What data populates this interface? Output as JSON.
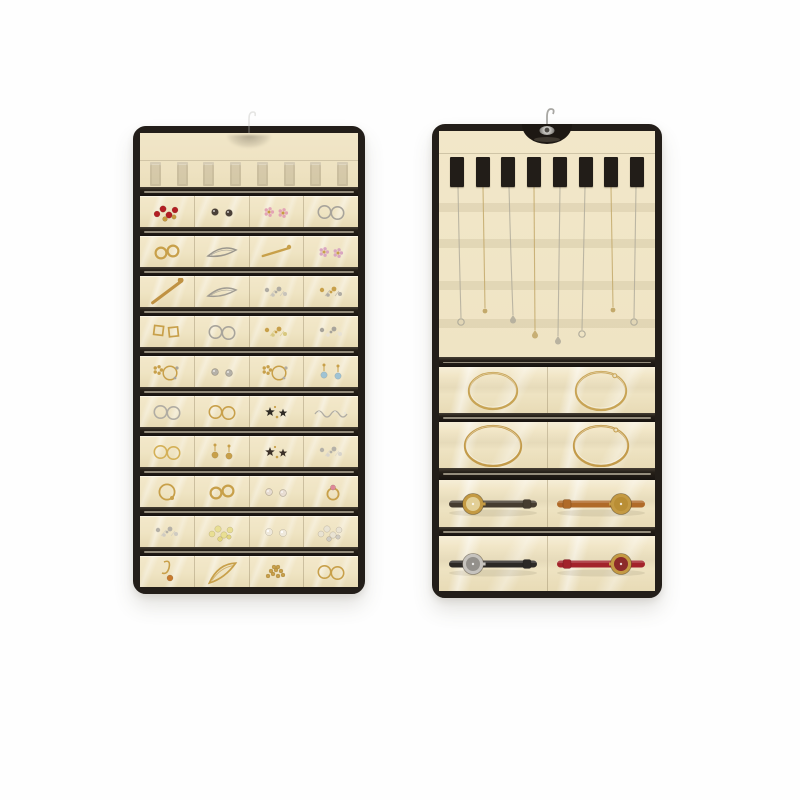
{
  "product": {
    "name": "dual-sided-hanging-jewelry-organizer",
    "sides": [
      "front-small-pocket-panel",
      "back-necklace-and-watch-panel"
    ]
  },
  "palette": {
    "background": "#fefefe",
    "fabric": "#efe4c5",
    "trim": "#231e19",
    "gold": "#c69f4a",
    "silver": "#aaa69c",
    "metal_hook": "#a8a7a3"
  },
  "front_panel": {
    "ghost_straps": 8,
    "rows": [
      [
        {
          "t": "beadcluster",
          "c": [
            "#b31e24",
            "#c79a3f"
          ],
          "n": "red-bead-gold-earrings"
        },
        {
          "t": "studs",
          "c": [
            "#4a4038",
            "#6a5f52"
          ],
          "n": "black-stud-earrings"
        },
        {
          "t": "flower",
          "c": [
            "#e3a4b5",
            "#c79a3f"
          ],
          "n": "pink-flower-stud"
        },
        {
          "t": "hoops2",
          "c": [
            "#a8a49b"
          ],
          "n": "silver-interlocked-hoops"
        }
      ],
      [
        {
          "t": "rings2",
          "c": [
            "#c8a04a"
          ],
          "n": "gold-ring-pair"
        },
        {
          "t": "marquise",
          "c": [
            "#9a968d"
          ],
          "n": "silver-dragonfly-brooch"
        },
        {
          "t": "pin",
          "c": [
            "#c8a04a"
          ],
          "n": "gold-bar-pin"
        },
        {
          "t": "flower",
          "c": [
            "#d9a6c0",
            "#c8a04a"
          ],
          "n": "pink-gold-flower-studs"
        }
      ],
      [
        {
          "t": "pin",
          "c": [
            "#c09243"
          ],
          "s": 1.3,
          "r": -20,
          "n": "gold-stick-pin"
        },
        {
          "t": "marquise",
          "c": [
            "#a09c93"
          ],
          "n": "silver-marquise-brooch"
        },
        {
          "t": "cluster",
          "c": [
            "#b0aca3",
            "#c8c4bb"
          ],
          "n": "silver-spectacle-studs"
        },
        {
          "t": "cluster",
          "c": [
            "#c8a04a",
            "#b0aca3"
          ],
          "n": "gold-butterfly-cluster"
        }
      ],
      [
        {
          "t": "squares2",
          "c": [
            "#c8a04a"
          ],
          "n": "gold-square-buckle-earrings"
        },
        {
          "t": "hoops2",
          "c": [
            "#a8a49b"
          ],
          "n": "silver-double-hoops"
        },
        {
          "t": "cluster",
          "c": [
            "#c8a04a",
            "#d8c87f"
          ],
          "n": "gold-stud-cluster"
        },
        {
          "t": "cluster",
          "c": [
            "#a8a49b",
            "#e8e2d4"
          ],
          "n": "silver-pearl-star-studs"
        }
      ],
      [
        {
          "t": "wreath",
          "c": [
            "#c8a04a",
            "#a8a49b"
          ],
          "n": "gold-flower-wreath-cluster"
        },
        {
          "t": "studs",
          "c": [
            "#b5b1a8",
            "#c8a04a"
          ],
          "n": "small-silver-studs"
        },
        {
          "t": "wreath",
          "c": [
            "#c8a04a",
            "#b0aca3"
          ],
          "n": "gold-ring-with-charms"
        },
        {
          "t": "drops2",
          "c": [
            "#9fc3d4",
            "#c8a04a"
          ],
          "n": "blue-stone-drop-earrings"
        }
      ],
      [
        {
          "t": "hoops2",
          "c": [
            "#b0aca3"
          ],
          "n": "silver-hoop-pair"
        },
        {
          "t": "hoops2",
          "c": [
            "#c8a04a"
          ],
          "n": "gold-clasp-hoops"
        },
        {
          "t": "star",
          "c": [
            "#2e2a24",
            "#c8a04a"
          ],
          "n": "black-flower-studs"
        },
        {
          "t": "chainline",
          "c": [
            "#b0aca3"
          ],
          "n": "silver-chain-bracelet"
        }
      ],
      [
        {
          "t": "hoops2",
          "c": [
            "#d4b056"
          ],
          "n": "gold-hoops-amber"
        },
        {
          "t": "drops2",
          "c": [
            "#c8a04a",
            "#c8a04a"
          ],
          "n": "gold-drop-earrings"
        },
        {
          "t": "star",
          "c": [
            "#3a3028",
            "#c8a04a"
          ],
          "n": "dark-star-charm"
        },
        {
          "t": "cluster",
          "c": [
            "#b5b1a8",
            "#d8d4cb"
          ],
          "n": "silver-cluster-studs"
        }
      ],
      [
        {
          "t": "hoop",
          "c": [
            "#c8a04a"
          ],
          "n": "gold-hoop-earring"
        },
        {
          "t": "rings2",
          "c": [
            "#c8a04a"
          ],
          "n": "gold-rings"
        },
        {
          "t": "studs",
          "c": [
            "#e8ddd2",
            "#e3a4b5"
          ],
          "n": "white-pink-studs"
        },
        {
          "t": "ring-stone",
          "c": [
            "#c8a04a",
            "#e08898"
          ],
          "n": "pink-stone-ring"
        }
      ],
      [
        {
          "t": "cluster",
          "c": [
            "#b5b1a8",
            "#cfcbc2"
          ],
          "n": "silver-flower-cluster"
        },
        {
          "t": "beadcluster",
          "c": [
            "#e9df93",
            "#e3d77f"
          ],
          "n": "yellow-bead-cluster"
        },
        {
          "t": "pearls2",
          "c": [
            "#efe9dc"
          ],
          "n": "pearl-stud-earrings"
        },
        {
          "t": "beadcluster",
          "c": [
            "#e9e3d3",
            "#cfcbc2"
          ],
          "n": "pearl-crystal-cluster"
        }
      ],
      [
        {
          "t": "drop-hook",
          "c": [
            "#c8a04a",
            "#c97b2d"
          ],
          "n": "gold-amber-drop-earring"
        },
        {
          "t": "marquise",
          "c": [
            "#c8a04a"
          ],
          "r": -25,
          "s": 1.15,
          "n": "gold-textured-leaf-brooch"
        },
        {
          "t": "heap",
          "c": [
            "#c8a04a"
          ],
          "n": "gold-chain-heap"
        },
        {
          "t": "hoops2",
          "c": [
            "#c8a04a"
          ],
          "n": "gold-double-hoop"
        }
      ]
    ]
  },
  "back_panel": {
    "straps": 8,
    "ghost_bands_y": [
      72,
      108,
      150,
      188
    ],
    "necklaces": [
      {
        "x": 19,
        "len": 187,
        "color": "#b2ad9c",
        "pendant": "ring",
        "drift": 3,
        "n": "silver-chain-necklace"
      },
      {
        "x": 44,
        "len": 177,
        "color": "#c3a96b",
        "pendant": "dot",
        "drift": 2,
        "n": "gold-chain-necklace"
      },
      {
        "x": 70,
        "len": 184,
        "color": "#b2ad9c",
        "pendant": "drop",
        "drift": 4,
        "n": "silver-pendant-necklace"
      },
      {
        "x": 95,
        "len": 199,
        "color": "#c3a96b",
        "pendant": "drop",
        "drift": 1,
        "n": "gold-pendant-necklace"
      },
      {
        "x": 121,
        "len": 205,
        "color": "#b2ad9c",
        "pendant": "drop",
        "drift": -2,
        "n": "silver-teardrop-necklace"
      },
      {
        "x": 146,
        "len": 199,
        "color": "#b2ad9c",
        "pendant": "ring",
        "drift": -3,
        "n": "silver-ring-pendant-necklace"
      },
      {
        "x": 172,
        "len": 176,
        "color": "#c3a96b",
        "pendant": "dot",
        "drift": 2,
        "n": "gold-short-necklace"
      },
      {
        "x": 197,
        "len": 187,
        "color": "#b2ad9c",
        "pendant": "ring",
        "drift": -2,
        "n": "silver-long-necklace"
      }
    ],
    "section_heights": [
      10,
      46,
      9,
      46,
      12,
      47,
      9,
      55
    ],
    "rows": [
      [
        {
          "t": "bangle",
          "c": [
            "#c8a455"
          ],
          "rx": 24,
          "ry": 18,
          "n": "gold-bangle-thin"
        },
        {
          "t": "bangle",
          "c": [
            "#c8a455"
          ],
          "rx": 25,
          "ry": 19,
          "clasp": true,
          "n": "gold-bangle-clasp"
        }
      ],
      [
        {
          "t": "bangle",
          "c": [
            "#c39b4a"
          ],
          "rx": 28,
          "ry": 20,
          "n": "gold-bangle-large"
        },
        {
          "t": "bangle",
          "c": [
            "#c39b4a"
          ],
          "rx": 27,
          "ry": 20,
          "clasp": true,
          "n": "gold-bangle-clasp-large"
        }
      ],
      [
        {
          "t": "watch",
          "strap": "#463c30",
          "face": "#c49a43",
          "dial": "#e2cf96",
          "side": "left",
          "n": "dark-strap-gold-face-watch"
        },
        {
          "t": "watch",
          "strap": "#b06a28",
          "face": "#c49a43",
          "dial": "#b98e35",
          "side": "right",
          "n": "tan-strap-gold-face-watch"
        }
      ],
      [
        {
          "t": "watch",
          "strap": "#2c2926",
          "face": "#c6c3be",
          "dial": "#93908b",
          "side": "left",
          "n": "black-strap-silver-face-watch"
        },
        {
          "t": "watch",
          "strap": "#a3232b",
          "face": "#c49a43",
          "dial": "#8c2a2a",
          "side": "right",
          "n": "red-strap-gold-face-watch"
        }
      ]
    ]
  }
}
